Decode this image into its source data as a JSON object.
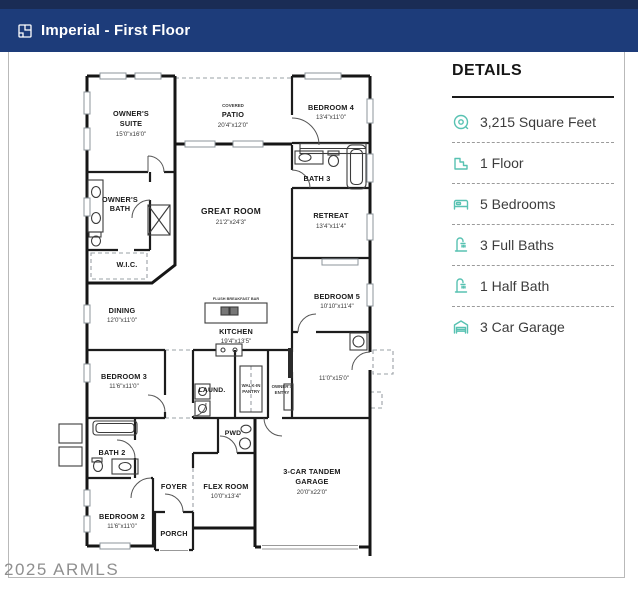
{
  "header": {
    "title": "Imperial - First Floor"
  },
  "details": {
    "title": "DETAILS",
    "items": [
      {
        "icon": "area-icon",
        "label": "3,215 Square Feet"
      },
      {
        "icon": "floor-icon",
        "label": "1 Floor"
      },
      {
        "icon": "bed-icon",
        "label": "5 Bedrooms"
      },
      {
        "icon": "full-bath-icon",
        "label": "3 Full Baths"
      },
      {
        "icon": "half-bath-icon",
        "label": "1 Half Bath"
      },
      {
        "icon": "garage-icon",
        "label": "3 Car Garage"
      }
    ]
  },
  "plan": {
    "rooms": {
      "owners_suite": {
        "l1": "OWNER'S",
        "l2": "SUITE",
        "dim": "15'0\"x16'0\""
      },
      "patio": {
        "sub": "COVERED",
        "l1": "PATIO",
        "dim": "20'4\"x12'0\""
      },
      "bedroom4": {
        "l1": "BEDROOM 4",
        "dim": "13'4\"x11'0\""
      },
      "bath3": {
        "l1": "BATH 3"
      },
      "retreat": {
        "l1": "RETREAT",
        "dim": "13'4\"x11'4\""
      },
      "great_room": {
        "l1": "GREAT ROOM",
        "dim": "21'2\"x24'3\""
      },
      "owners_bath": {
        "l1": "OWNER'S",
        "l2": "BATH"
      },
      "wic": {
        "l1": "W.I.C."
      },
      "dining": {
        "l1": "DINING",
        "dim": "12'0\"x11'0\""
      },
      "kitchen": {
        "l1": "KITCHEN",
        "dim": "19'4\"x13'5\"",
        "bar": "FLUSH BREAKFAST BAR"
      },
      "bedroom5": {
        "l1": "BEDROOM 5",
        "dim": "10'10\"x11'4\""
      },
      "hall": {
        "dim": "11'0\"x15'0\""
      },
      "bedroom3": {
        "l1": "BEDROOM 3",
        "dim": "11'6\"x11'0\""
      },
      "laundry": {
        "l1": "LAUND."
      },
      "pantry": {
        "l1": "WALK-IN",
        "l2": "PANTRY"
      },
      "owners_entry": {
        "l1": "OWNER'S",
        "l2": "ENTRY"
      },
      "bath2": {
        "l1": "BATH 2"
      },
      "pwd": {
        "l1": "PWD"
      },
      "foyer": {
        "l1": "FOYER"
      },
      "flex": {
        "l1": "FLEX ROOM",
        "dim": "10'0\"x13'4\""
      },
      "bedroom2": {
        "l1": "BEDROOM 2",
        "dim": "11'6\"x11'0\""
      },
      "porch": {
        "l1": "PORCH"
      },
      "garage": {
        "l1": "3-CAR TANDEM",
        "l2": "GARAGE",
        "dim": "20'0\"x22'0\""
      }
    }
  },
  "watermark": {
    "text": "2025 ARMLS"
  },
  "colors": {
    "header_bar": "#1d3c7a",
    "header_strip": "#1a2c55",
    "icon_teal": "#58c2b2"
  }
}
